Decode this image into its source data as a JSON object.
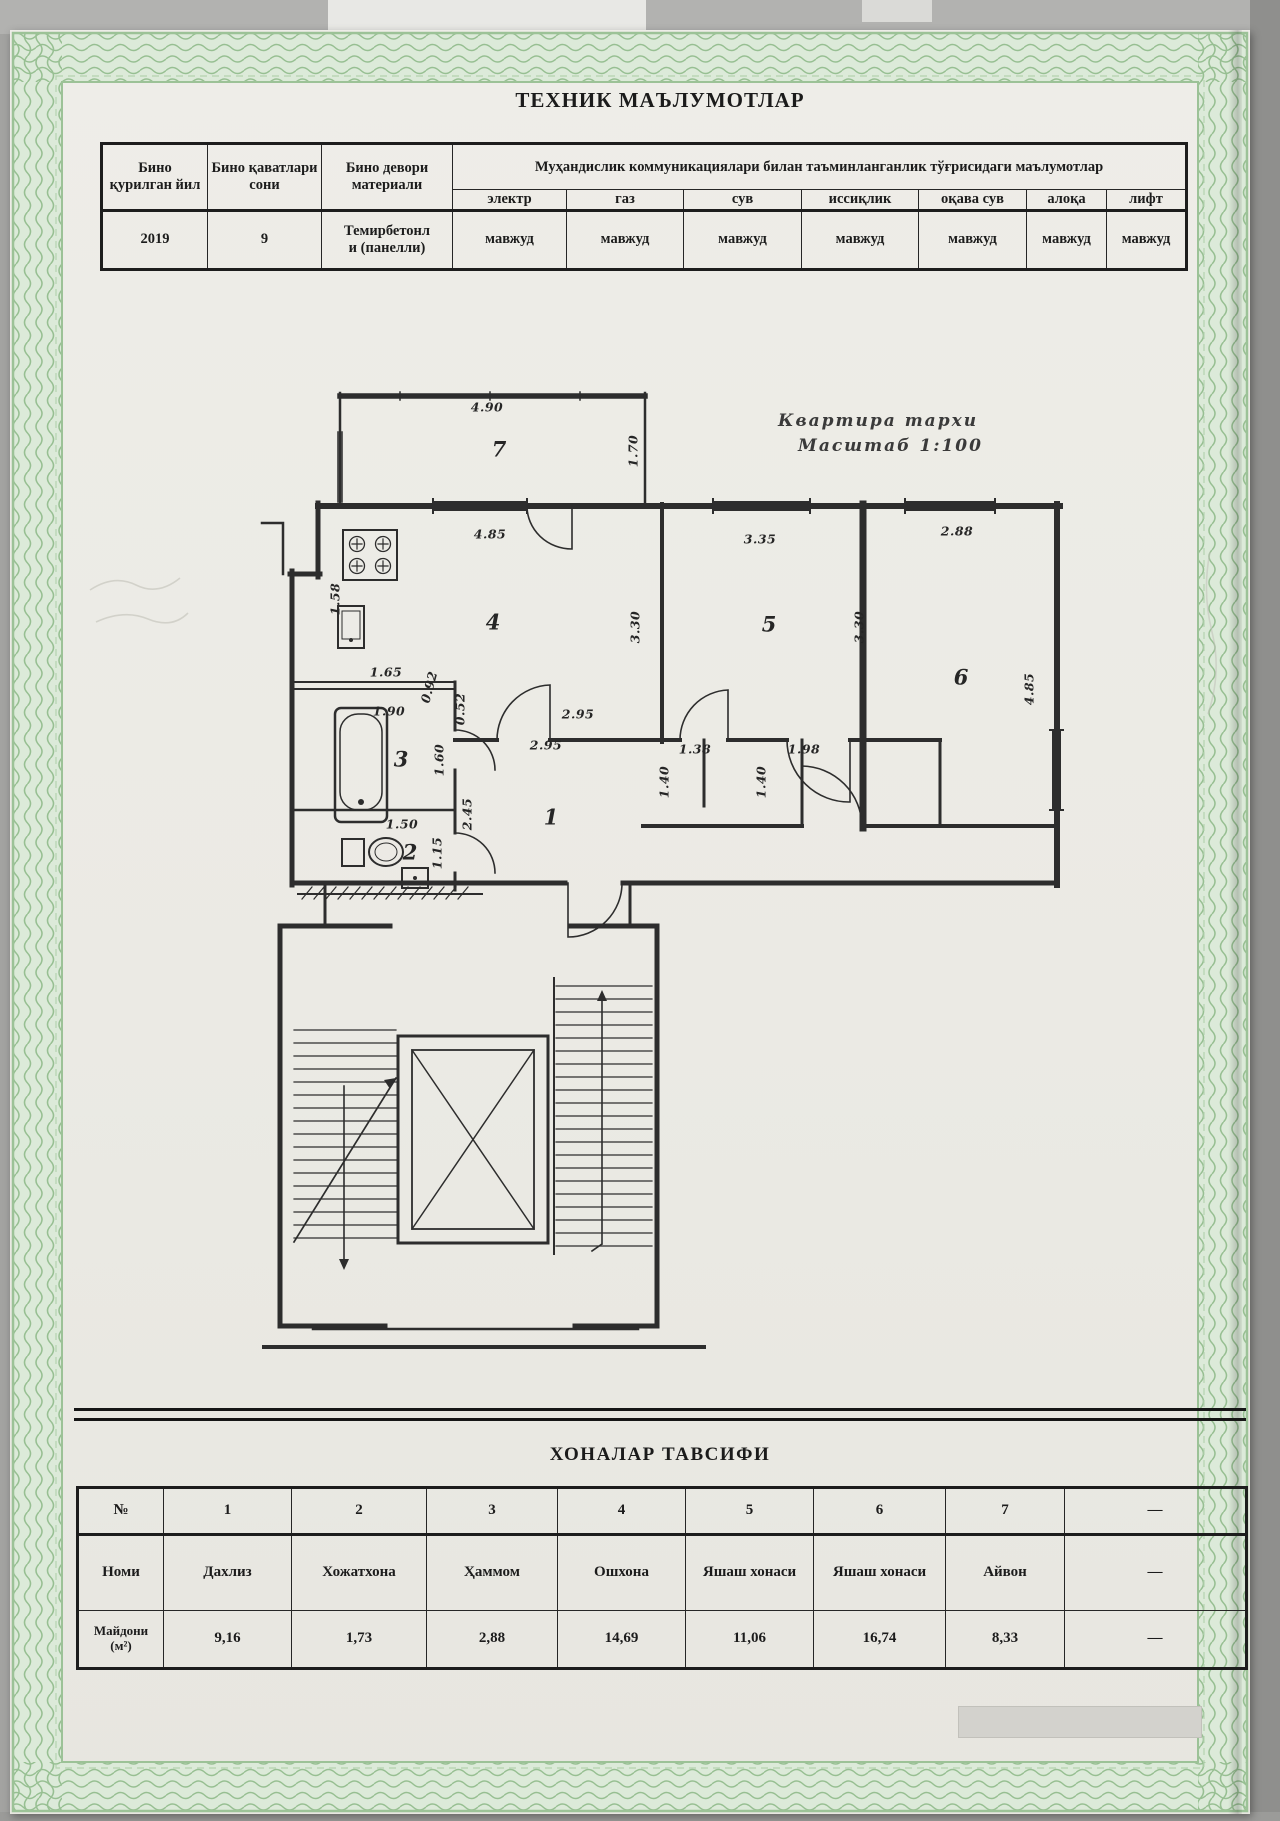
{
  "page": {
    "doc_title": "ТЕХНИК МАЪЛУМОТЛАР",
    "rooms_section_title": "ХОНАЛАР ТАВСИФИ"
  },
  "top_table": {
    "col_building_year": "Бино қурилган йил",
    "col_floors": "Бино қаватлари сони",
    "col_material": "Бино девори материали",
    "col_comm": "Муҳандислик коммуникациялари билан таъминланганлик тўғрисидаги маълумотлар",
    "sub_cols": [
      "электр",
      "газ",
      "сув",
      "иссиқлик",
      "оқава сув",
      "алоқа",
      "лифт"
    ],
    "row": {
      "year": "2019",
      "floors": "9",
      "material_1": "Темирбетонл",
      "material_2": "и (панелли)",
      "availability": [
        "мавжуд",
        "мавжуд",
        "мавжуд",
        "мавжуд",
        "мавжуд",
        "мавжуд",
        "мавжуд"
      ]
    }
  },
  "plan": {
    "title_line1": "Квартира тархи",
    "title_line2": "Масштаб 1:100",
    "labels": [
      {
        "t": "4.90",
        "x": 237,
        "y": 29
      },
      {
        "t": "7",
        "x": 249,
        "y": 71,
        "s": "room"
      },
      {
        "t": "1.70",
        "x": 383,
        "y": 73,
        "r": -90
      },
      {
        "t": "4.85",
        "x": 240,
        "y": 156
      },
      {
        "t": "1.58",
        "x": 85,
        "y": 221,
        "r": -90
      },
      {
        "t": "4",
        "x": 243,
        "y": 244,
        "s": "room"
      },
      {
        "t": "3.35",
        "x": 510,
        "y": 161
      },
      {
        "t": "5",
        "x": 519,
        "y": 246,
        "s": "room"
      },
      {
        "t": "3.30",
        "x": 385,
        "y": 249,
        "r": -90
      },
      {
        "t": "3.30",
        "x": 609,
        "y": 249,
        "r": -90
      },
      {
        "t": "2.88",
        "x": 707,
        "y": 153
      },
      {
        "t": "6",
        "x": 711,
        "y": 299,
        "s": "room"
      },
      {
        "t": "4.85",
        "x": 779,
        "y": 311,
        "r": -90
      },
      {
        "t": "1.65",
        "x": 136,
        "y": 294
      },
      {
        "t": "0.92",
        "x": 179,
        "y": 309,
        "r": -75
      },
      {
        "t": "1.90",
        "x": 139,
        "y": 333
      },
      {
        "t": "0.52",
        "x": 210,
        "y": 331,
        "r": -90
      },
      {
        "t": "2.95",
        "x": 328,
        "y": 336
      },
      {
        "t": "2.95",
        "x": 296,
        "y": 367
      },
      {
        "t": "3",
        "x": 151,
        "y": 381,
        "s": "room"
      },
      {
        "t": "1.60",
        "x": 189,
        "y": 382,
        "r": -90
      },
      {
        "t": "2.45",
        "x": 217,
        "y": 436,
        "r": -90
      },
      {
        "t": "1.50",
        "x": 152,
        "y": 446
      },
      {
        "t": "2",
        "x": 160,
        "y": 474,
        "s": "room"
      },
      {
        "t": "1.15",
        "x": 187,
        "y": 475,
        "r": -90
      },
      {
        "t": "1.38",
        "x": 445,
        "y": 371
      },
      {
        "t": "1.98",
        "x": 554,
        "y": 371
      },
      {
        "t": "1.40",
        "x": 414,
        "y": 404,
        "r": -90
      },
      {
        "t": "1.40",
        "x": 511,
        "y": 404,
        "r": -90
      },
      {
        "t": "1",
        "x": 301,
        "y": 439,
        "s": "room"
      }
    ]
  },
  "rooms_table": {
    "header": [
      "№",
      "1",
      "2",
      "3",
      "4",
      "5",
      "6",
      "7",
      "—"
    ],
    "name_label": "Номи",
    "names": [
      "Дахлиз",
      "Хожатхона",
      "Ҳаммом",
      "Ошхона",
      "Яшаш хонаси",
      "Яшаш хонаси",
      "Айвон",
      "—"
    ],
    "area_label_1": "Майдони",
    "area_label_2": "(м²)",
    "areas": [
      "9,16",
      "1,73",
      "2,88",
      "14,69",
      "11,06",
      "16,74",
      "8,33",
      "—"
    ]
  }
}
